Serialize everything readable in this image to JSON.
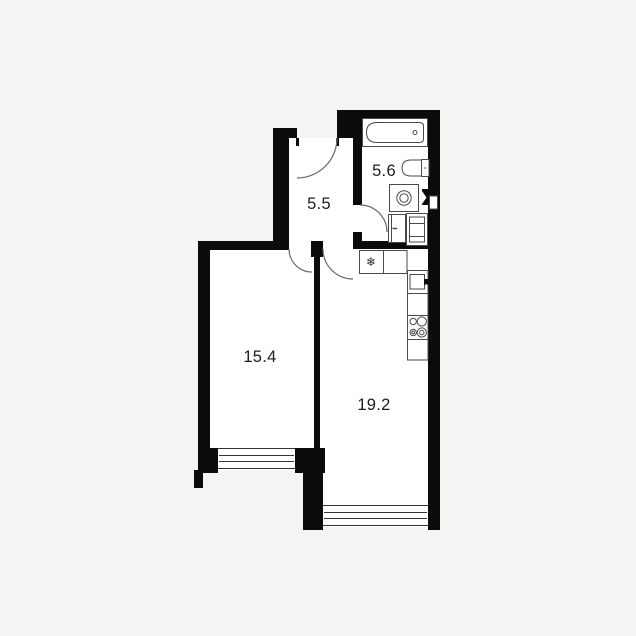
{
  "floorplan": {
    "type": "apartment-floor-plan",
    "rooms": [
      {
        "id": "hallway",
        "area_label": "5.5"
      },
      {
        "id": "bathroom",
        "area_label": "5.6"
      },
      {
        "id": "bedroom",
        "area_label": "15.4"
      },
      {
        "id": "kitchen_living",
        "area_label": "19.2"
      }
    ],
    "symbols": {
      "fridge_snowflake": "❄"
    },
    "colors": {
      "wall": "#0b0b0b",
      "room_fill": "#ffffff",
      "background": "#f4f4f2",
      "fixture_stroke": "#4a4a4a",
      "window_stroke": "#333333",
      "door_arc": "#6a6a6a",
      "label": "#1c1c1c"
    }
  }
}
